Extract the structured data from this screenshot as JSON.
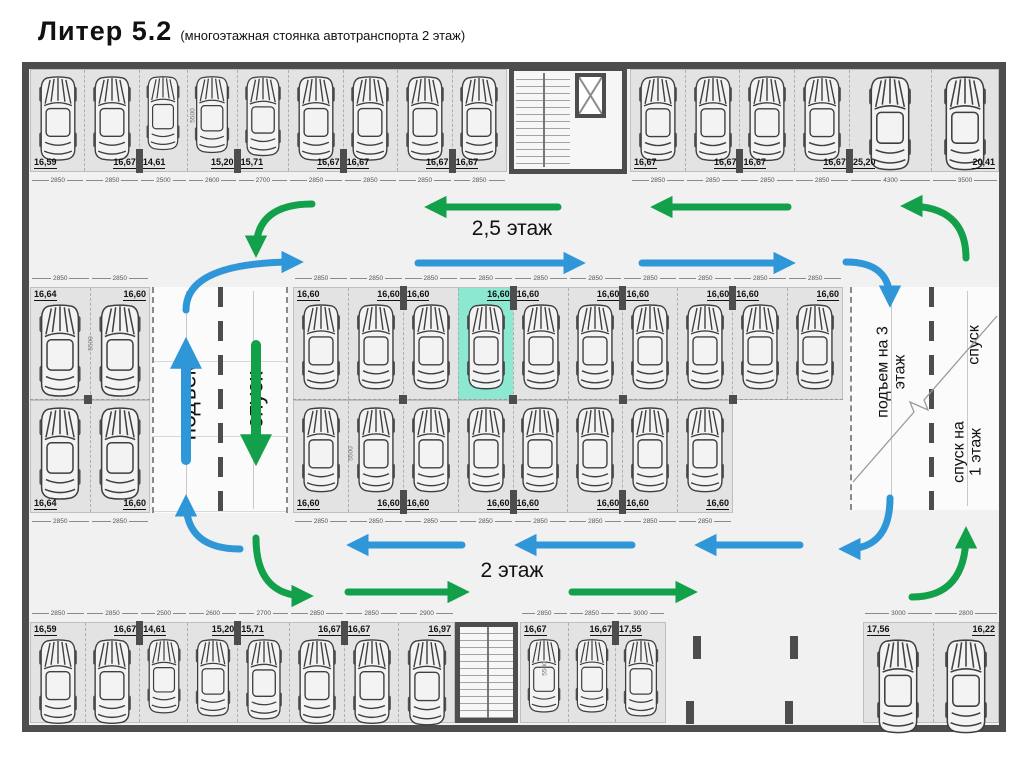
{
  "title": {
    "main": "Литер 5.2",
    "sub": "(многоэтажная стоянка автотранспорта 2 этаж)"
  },
  "floor_labels": {
    "upper_aisle": "2,5 этаж",
    "lower_aisle": "2 этаж"
  },
  "ramp_labels": {
    "left_up": "подъем",
    "left_down": "спуск",
    "right_up": "подъем на 3 этаж",
    "right_down_upper": "спуск",
    "right_down_lower": "спуск на 1 этаж"
  },
  "depth_dim": "5500",
  "colors": {
    "route_up_blue": "#2f97d8",
    "route_down_green": "#13a04a",
    "highlight_teal": "#8ce8d1",
    "wall_gray": "#4d4d4d",
    "stall_gray": "#e3e3e3"
  },
  "parking_rows": {
    "top_left": {
      "aisle": "bottom",
      "areas": [
        "16,59",
        "16,67",
        "14,61",
        "15,20",
        "15,71",
        "16,67",
        "16,67",
        "16,67",
        "16,67"
      ],
      "dims": [
        "2850",
        "2850",
        "2500",
        "2600",
        "2700",
        "2850",
        "2850",
        "2850",
        "2850"
      ]
    },
    "top_right": {
      "aisle": "bottom",
      "areas": [
        "16,67",
        "16,67",
        "16,67",
        "16,67",
        "25,20",
        "20,41"
      ],
      "dims": [
        "2850",
        "2850",
        "2850",
        "2850",
        "4300",
        "3500"
      ]
    },
    "mid_left_top": {
      "aisle": "top",
      "areas": [
        "16,64",
        "16,60"
      ],
      "dims": [
        "2850",
        "2850"
      ]
    },
    "mid_left_bottom": {
      "aisle": "bottom",
      "areas": [
        "16,64",
        "16,60"
      ],
      "dims": [
        "2850",
        "2850"
      ]
    },
    "mid_center_top": {
      "aisle": "top",
      "highlight": 3,
      "areas": [
        "16,60",
        "16,60",
        "16,60",
        "16,60",
        "16,60",
        "16,60",
        "16,60",
        "16,60",
        "16,60",
        "16,60"
      ],
      "dims": [
        "2850",
        "2850",
        "2850",
        "2850",
        "2850",
        "2850",
        "2850",
        "2850",
        "2850",
        "2850"
      ]
    },
    "mid_center_bottom": {
      "aisle": "bottom",
      "areas": [
        "16,60",
        "16,60",
        "16,60",
        "16,60",
        "16,60",
        "16,60",
        "16,60",
        "16,60"
      ],
      "dims": [
        "2850",
        "2850",
        "2850",
        "2850",
        "2850",
        "2850",
        "2850",
        "2850"
      ]
    },
    "bottom_left": {
      "aisle": "top",
      "areas": [
        "16,59",
        "16,67",
        "14,61",
        "15,20",
        "15,71",
        "16,67",
        "16,67",
        "16,97"
      ],
      "dims": [
        "2850",
        "2850",
        "2500",
        "2600",
        "2700",
        "2850",
        "2850",
        "2900"
      ]
    },
    "bottom_mid": {
      "aisle": "top",
      "areas": [
        "16,67",
        "16,67",
        "17,55"
      ],
      "dims": [
        "2850",
        "2850",
        "3000"
      ]
    },
    "bottom_right": {
      "aisle": "top",
      "areas": [
        "17,56",
        "16,22"
      ],
      "dims": [
        "3000",
        "2800"
      ]
    }
  }
}
